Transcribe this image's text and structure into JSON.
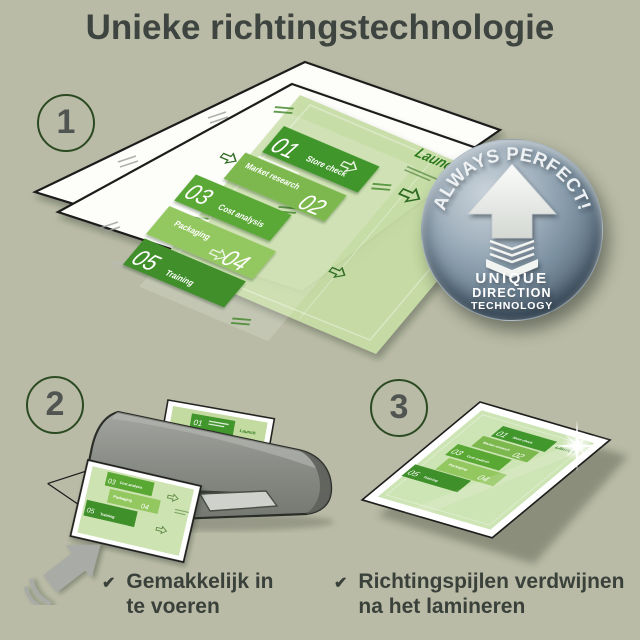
{
  "title": {
    "text": "Unieke richtingstechnologie"
  },
  "steps": [
    {
      "number": "1"
    },
    {
      "number": "2"
    },
    {
      "number": "3"
    }
  ],
  "document": {
    "launch_label": "Launch",
    "items": [
      {
        "num": "01",
        "label": "Store check"
      },
      {
        "num": "02",
        "label": "Market research"
      },
      {
        "num": "03",
        "label": "Cost analysis"
      },
      {
        "num": "04",
        "label": "Packaging"
      },
      {
        "num": "05",
        "label": "Training"
      }
    ]
  },
  "badge": {
    "arc_text": "ALWAYS PERFECT!",
    "line1": "UNIQUE",
    "line2": "DIRECTION",
    "line3": "TECHNOLOGY"
  },
  "captions": [
    {
      "check": "✔",
      "line1": "Gemakkelijk in",
      "line2": "te voeren"
    },
    {
      "check": "✔",
      "line1": "Richtingspijlen verdwijnen",
      "line2": "na het lamineren"
    }
  ],
  "colors": {
    "background": "#b9bba6",
    "title_text": "#3e4440",
    "green_dark": "#41962c",
    "green_mid": "#5aa834",
    "green_light": "#93c75f",
    "green_pale": "#7cb84e",
    "sheet_green": "#c7dda6",
    "launch_green": "#2e7a1e",
    "badge_gray_blue": "#5d7081",
    "machine_gray": "#8b8e88"
  }
}
